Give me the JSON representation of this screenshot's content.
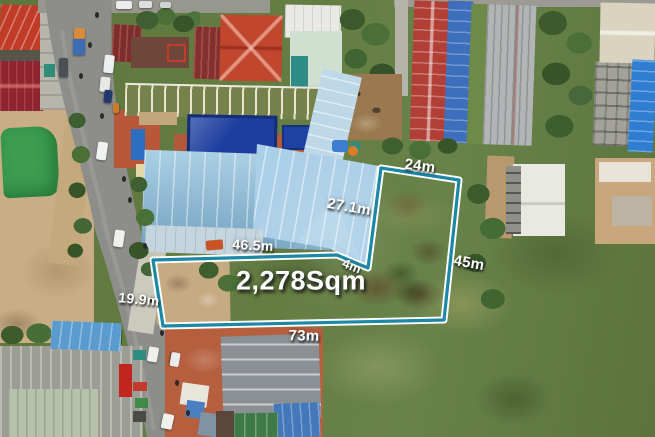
{
  "photo": {
    "type": "aerial drone photo of a land plot outlined for sale",
    "area_label": "2,278Sqm",
    "measurements": {
      "top_edge": "24m",
      "upper_diagonal_edge": "27.1m",
      "inner_top_edge": "46.5m",
      "notch_edge": "4m",
      "right_edge": "45m",
      "road_frontage_edge": "19.9m",
      "bottom_edge": "73m"
    },
    "boundary_colors": {
      "core": "#1d87a6",
      "edge": "#ffffff"
    },
    "label_color": "#ffffff"
  }
}
